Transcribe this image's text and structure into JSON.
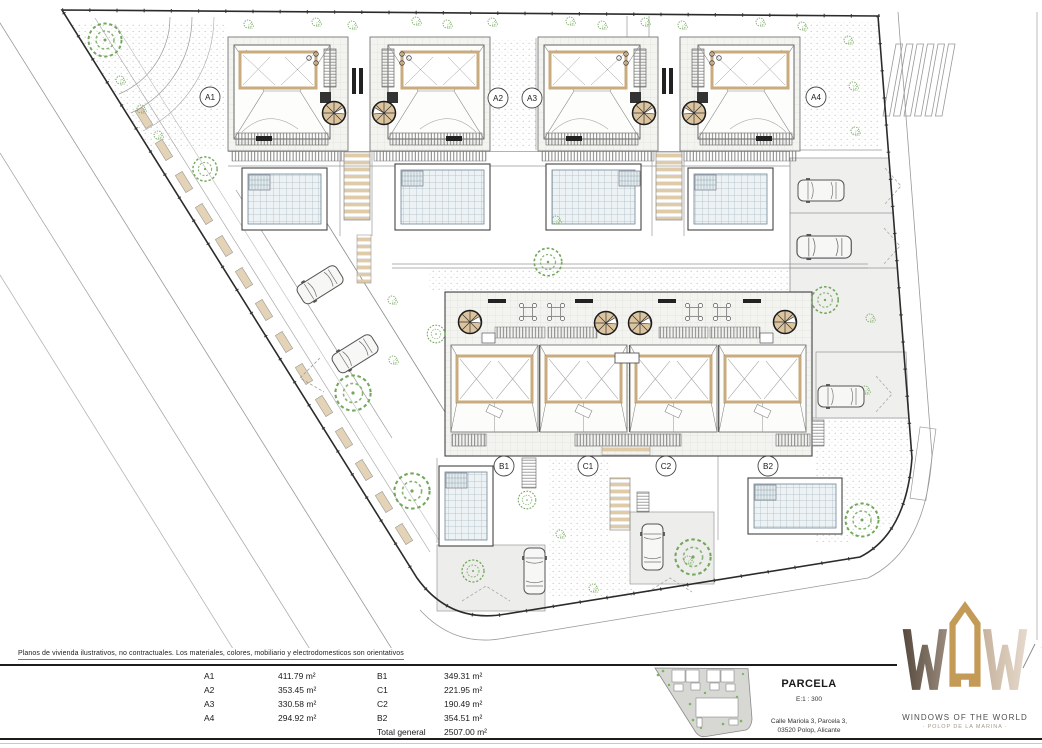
{
  "plan": {
    "unit_labels": [
      "A1",
      "A2",
      "A3",
      "A4",
      "B1",
      "C1",
      "C2",
      "B2"
    ]
  },
  "footer": {
    "disclaimer": "Planos de vivienda ilustrativos, no contractuales. Los materiales, colores, mobiliario y electrodomesticos son orientativos",
    "areas": {
      "col1": [
        {
          "label": "A1",
          "value": "411.79 m²"
        },
        {
          "label": "A2",
          "value": "353.45 m²"
        },
        {
          "label": "A3",
          "value": "330.58 m²"
        },
        {
          "label": "A4",
          "value": "294.92 m²"
        }
      ],
      "col2": [
        {
          "label": "B1",
          "value": "349.31 m²"
        },
        {
          "label": "C1",
          "value": "221.95 m²"
        },
        {
          "label": "C2",
          "value": "190.49 m²"
        },
        {
          "label": "B2",
          "value": "354.51 m²"
        },
        {
          "label": "Total general",
          "value": "2507.00 m²"
        }
      ]
    },
    "parcela": {
      "title": "PARCELA",
      "scale": "E:1 : 300",
      "address_line1": "Calle Mariola 3, Parcela 3,",
      "address_line2": "03520 Polop, Alicante"
    },
    "logo": {
      "brand": "WINDOWS OF THE WORLD",
      "tagline": "· POLOP DE LA MARINA ·",
      "colors": {
        "w_dark": "#6e6052",
        "o_gold": "#c49a57",
        "w_light": "#d7c6b4"
      }
    }
  }
}
